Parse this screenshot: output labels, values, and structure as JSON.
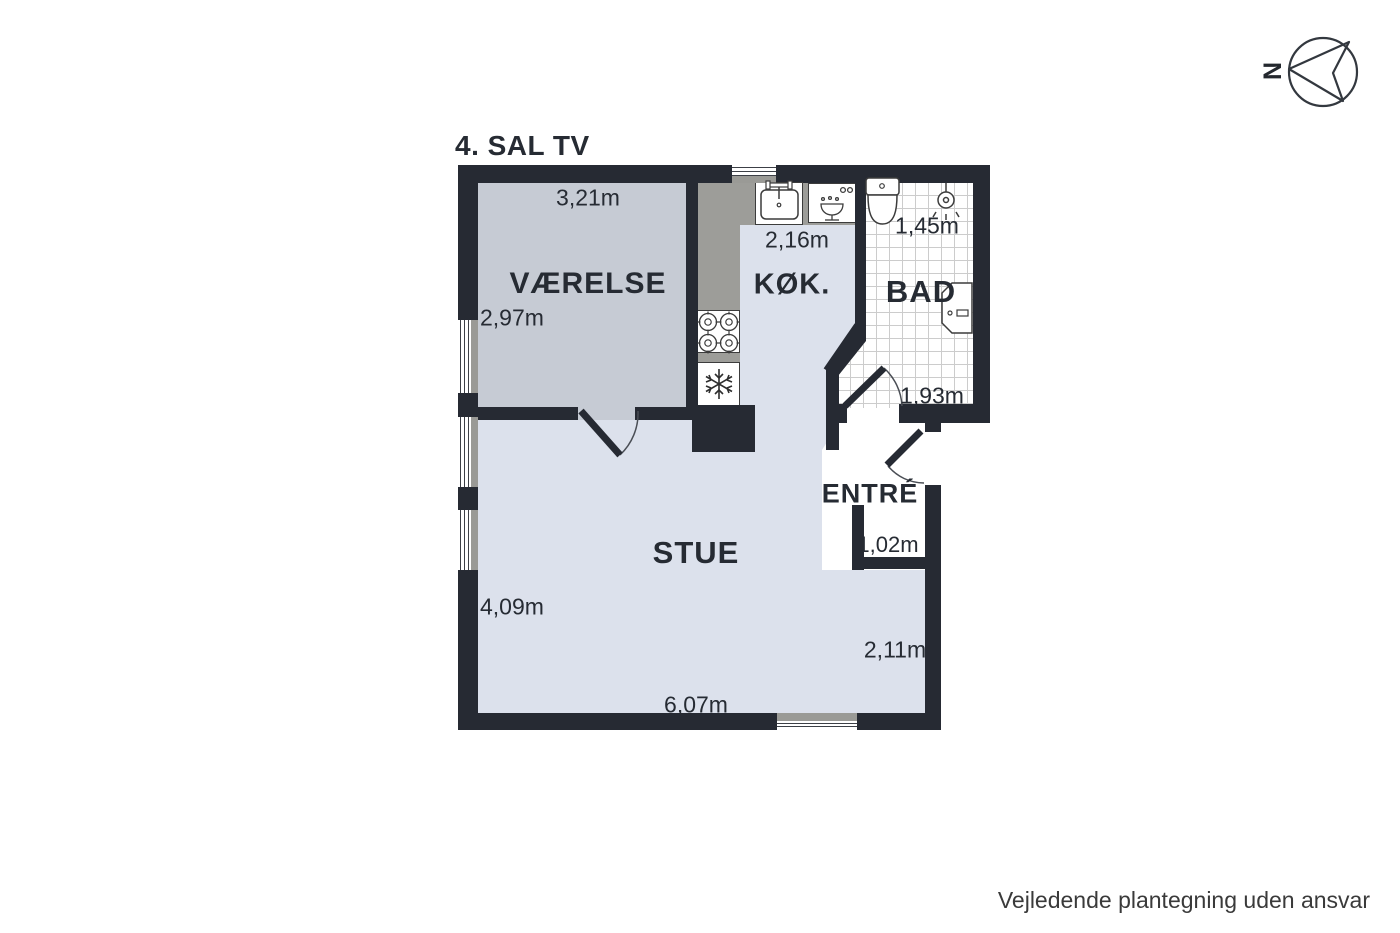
{
  "title": "4. SAL TV",
  "compass": {
    "north_label": "N"
  },
  "disclaimer": "Vejledende plantegning uden ansvar",
  "rooms": {
    "vaerelse": {
      "label": "VÆRELSE",
      "width_m": "3,21m",
      "depth_m": "2,97m"
    },
    "kok": {
      "label": "KØK.",
      "width_m": "2,16m"
    },
    "bad": {
      "label": "BAD",
      "width_m": "1,45m",
      "entry_m": "1,93m"
    },
    "entre": {
      "label": "ENTRÉ",
      "nook_m": "1,02m"
    },
    "stue": {
      "label": "STUE",
      "depth_m": "4,09m",
      "width_m": "6,07m",
      "right_depth_m": "2,11m"
    }
  },
  "fixtures": [
    "kitchen-sink",
    "dishwasher",
    "stove",
    "freezer",
    "toilet",
    "shower",
    "bath-sink"
  ],
  "colors": {
    "wall": "#262a33",
    "vaerelse_floor": "#c6cbd4",
    "stue_floor": "#dce1ec",
    "counter": "#9d9d99",
    "tile_line": "#cccccc",
    "text": "#262b33"
  }
}
